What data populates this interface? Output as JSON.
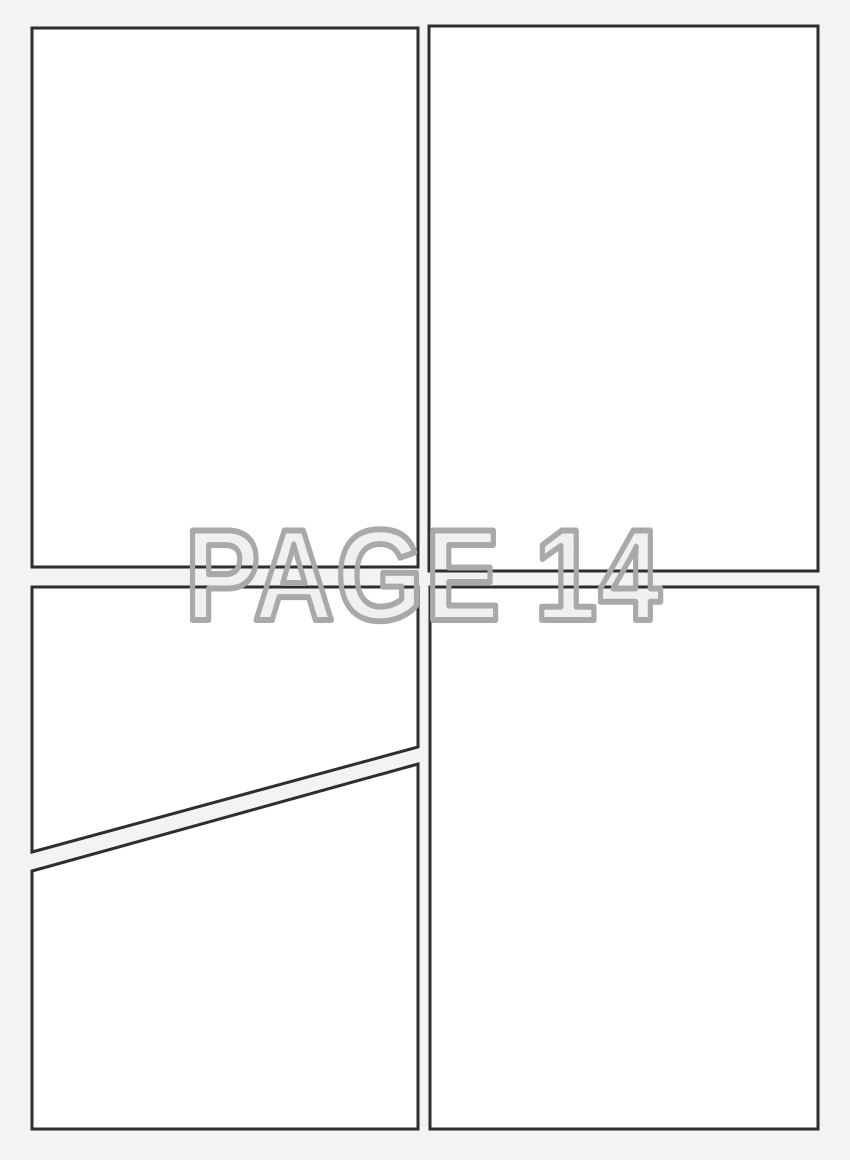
{
  "page": {
    "watermark_text": "PAGE 14",
    "page_number": "14"
  },
  "panels": {
    "count": 5,
    "names": [
      "top-left-panel",
      "top-right-panel",
      "middle-left-upper-panel",
      "bottom-left-panel",
      "bottom-right-panel"
    ]
  },
  "colors": {
    "background": "#f3f3f3",
    "panel_fill": "#ffffff",
    "panel_border": "#2e2e2e",
    "watermark_fill": "#f0f0f0",
    "watermark_outline": "#a9a9a9"
  }
}
